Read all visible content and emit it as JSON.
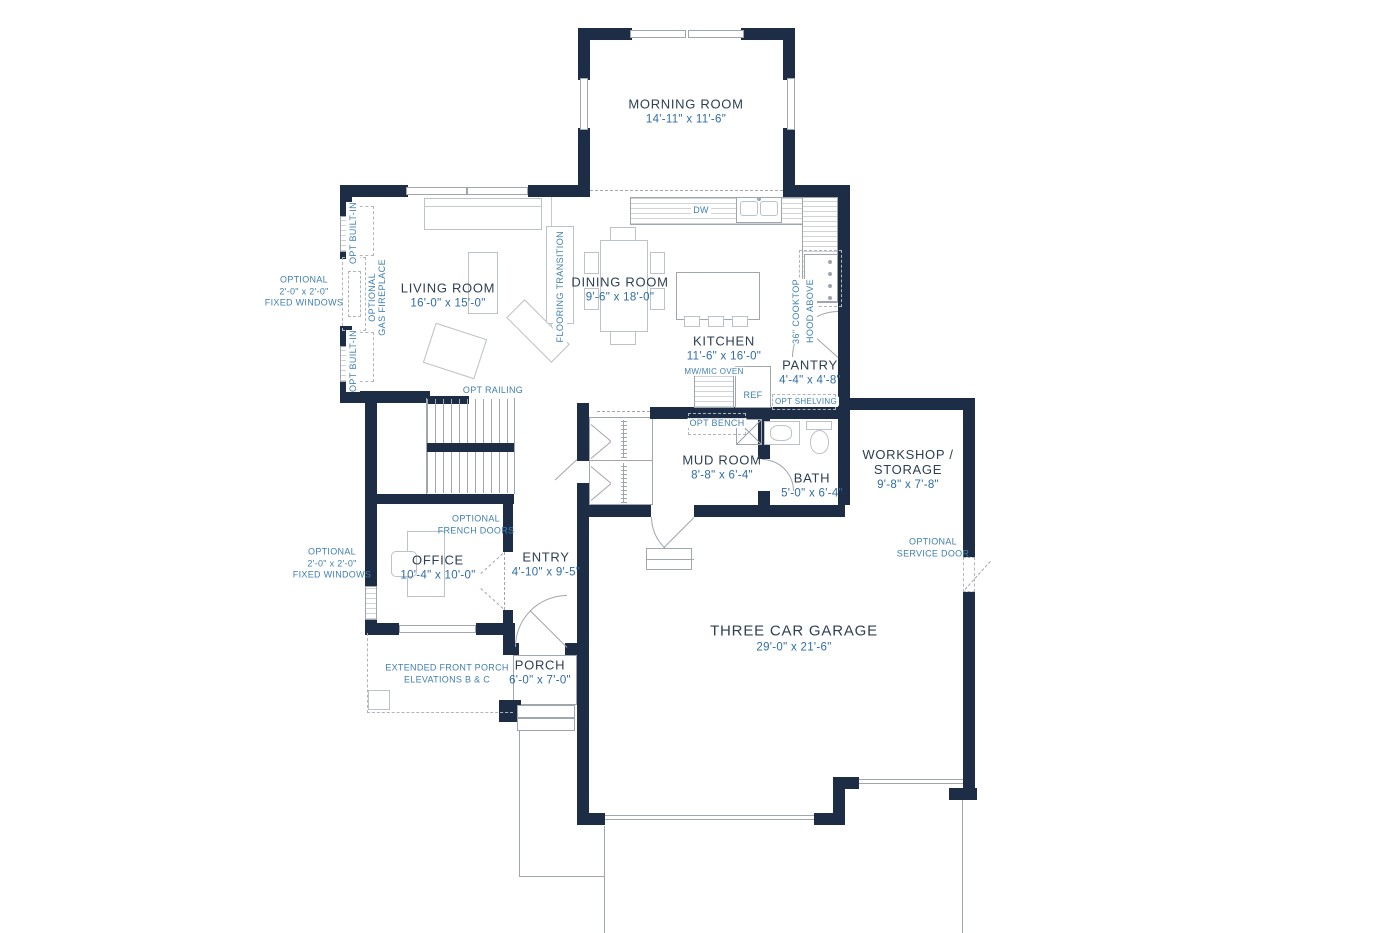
{
  "colors": {
    "wall": "#1c2d45",
    "room_label": "#2e3f52",
    "dimension": "#2f6da6",
    "annotation": "#4080b0",
    "line": "#9fa6ae"
  },
  "rooms": {
    "morning_room": {
      "name": "MORNING ROOM",
      "dims": "14'-11\" x 11'-6\""
    },
    "living_room": {
      "name": "LIVING ROOM",
      "dims": "16'-0\" x 15'-0\""
    },
    "dining_room": {
      "name": "DINING ROOM",
      "dims": "9'-6\" x 18'-0\""
    },
    "kitchen": {
      "name": "KITCHEN",
      "dims": "11'-6\" x 16'-0\""
    },
    "pantry": {
      "name": "PANTRY",
      "dims": "4'-4\" x 4'-8\""
    },
    "mud_room": {
      "name": "MUD ROOM",
      "dims": "8'-8\" x 6'-4\""
    },
    "bath": {
      "name": "BATH",
      "dims": "5'-0\" x 6'-4\""
    },
    "workshop": {
      "name_line1": "WORKSHOP /",
      "name_line2": "STORAGE",
      "dims": "9'-8\" x 7'-8\""
    },
    "office": {
      "name": "OFFICE",
      "dims": "10'-4\" x 10'-0\""
    },
    "entry": {
      "name": "ENTRY",
      "dims": "4'-10\" x 9'-5\""
    },
    "garage": {
      "name": "THREE CAR GARAGE",
      "dims": "29'-0\" x 21'-6\""
    },
    "porch": {
      "name": "PORCH",
      "dims": "6'-0\" x 7'-0\""
    }
  },
  "annotations": {
    "opt_built_in": "OPT BUILT-IN",
    "optional_gas_fireplace": [
      "OPTIONAL",
      "GAS FIREPLACE"
    ],
    "fixed_windows": [
      "OPTIONAL",
      "2'-0\" x 2'-0\"",
      "FIXED WINDOWS"
    ],
    "flooring_transition": "FLOORING TRANSITION",
    "opt_railing": "OPT RAILING",
    "dw": "DW",
    "cooktop": [
      "36\" COOKTOP",
      "HOOD ABOVE"
    ],
    "mw_oven": "MW/MIC OVEN",
    "ref": "REF",
    "opt_shelving": "OPT SHELVING",
    "opt_bench": "OPT BENCH",
    "french_doors": [
      "OPTIONAL",
      "FRENCH DOORS"
    ],
    "service_door": [
      "OPTIONAL",
      "SERVICE DOOR"
    ],
    "extended_porch": [
      "EXTENDED FRONT PORCH",
      "ELEVATIONS B & C"
    ]
  }
}
